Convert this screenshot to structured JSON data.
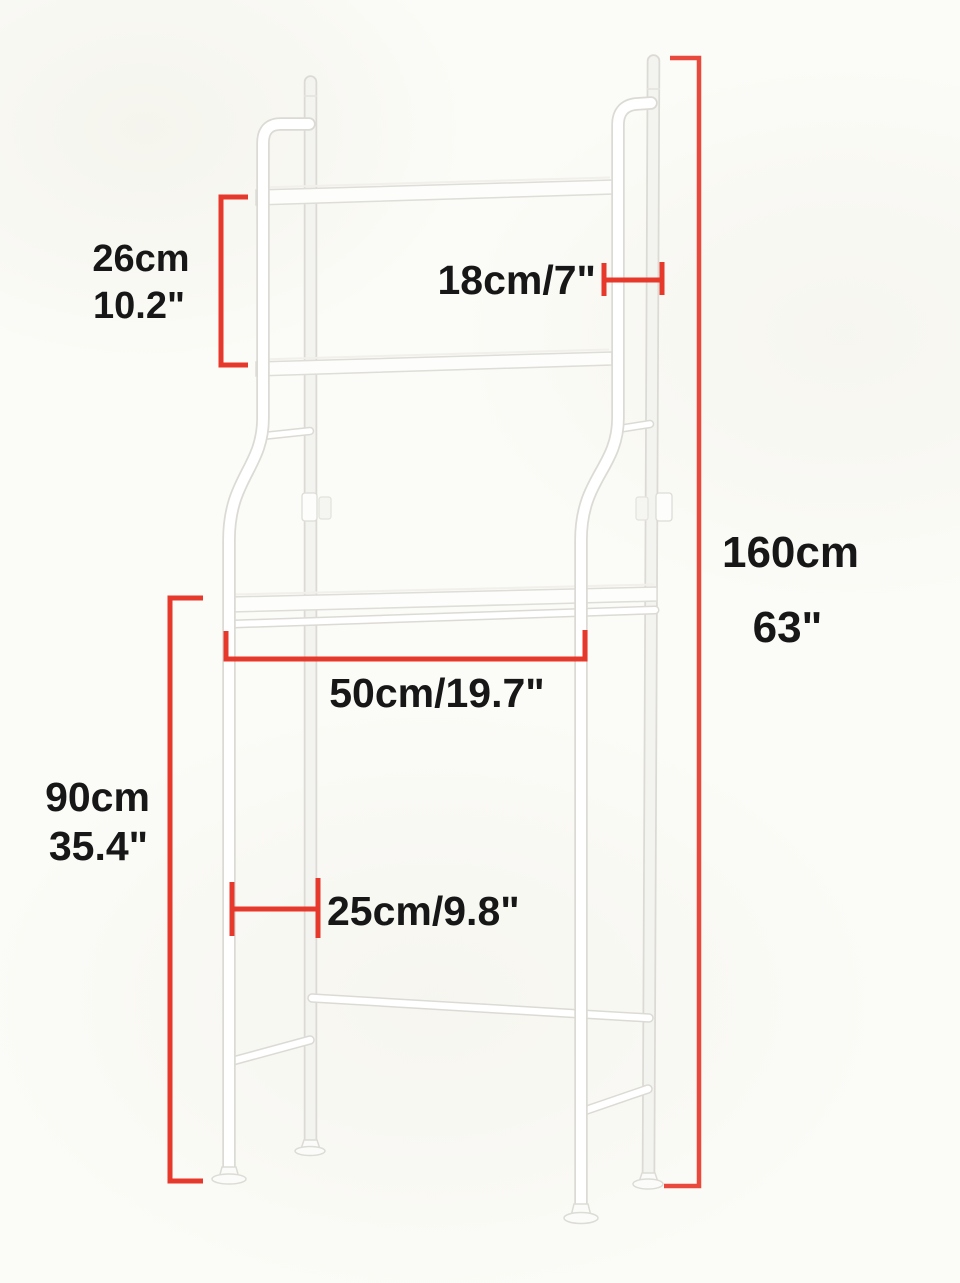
{
  "meta": {
    "description": "Dimension diagram of a white over-the-toilet bathroom storage rack with three shelves",
    "unit_style": "metric and imperial"
  },
  "colors": {
    "background": "#fbfbf7",
    "dimension_red": "#e7382c",
    "label_text": "#171717",
    "rack_tube_fill": "#ffffff",
    "rack_tube_outline": "#dcdad4"
  },
  "dimensions": {
    "shelf_spacing": {
      "cm": "26cm",
      "inch": "10.2\""
    },
    "top_shelf_depth": {
      "combined": "18cm/7\""
    },
    "overall_height": {
      "cm": "160cm",
      "inch": "63\""
    },
    "inner_width": {
      "combined": "50cm/19.7\""
    },
    "clearance_height": {
      "cm": "90cm",
      "inch": "35.4\""
    },
    "side_depth": {
      "combined": "25cm/9.8\""
    }
  }
}
